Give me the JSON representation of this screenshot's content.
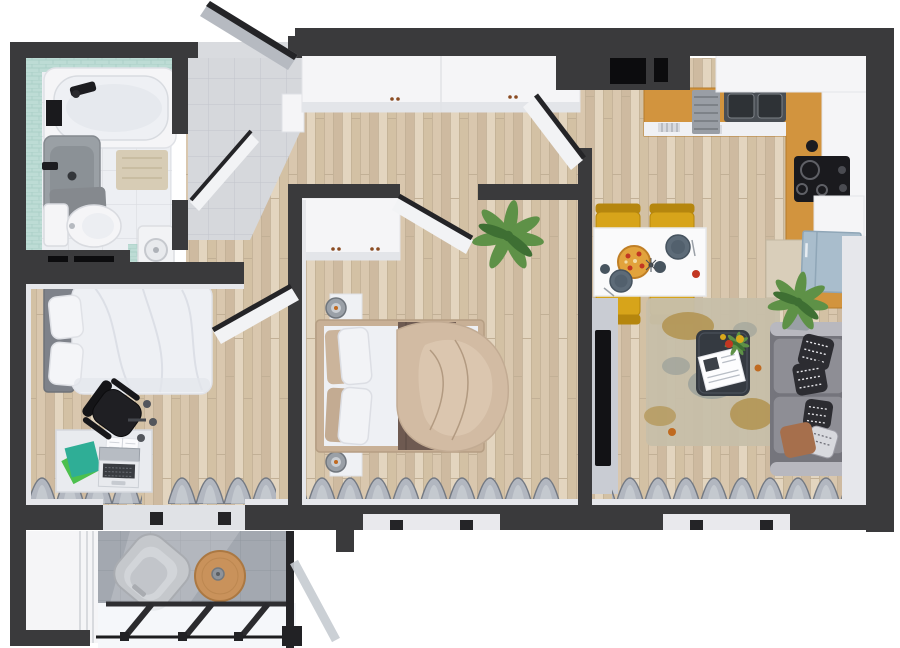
{
  "scene": {
    "type": "3d-floor-plan-top-view",
    "rooms": [
      {
        "name": "bathroom",
        "items": [
          "bathtub",
          "vanity-sink",
          "toilet",
          "washing-machine",
          "bath-mat",
          "toilet-mat"
        ]
      },
      {
        "name": "entry-hall",
        "items": [
          "front-door",
          "entry-tiles",
          "shoe-cabinet"
        ]
      },
      {
        "name": "hallway",
        "items": [
          "wardrobe"
        ]
      },
      {
        "name": "bedroom-1",
        "items": [
          "single-bed",
          "pillows",
          "desk",
          "laptop",
          "notebooks",
          "office-chair",
          "curtains",
          "window"
        ]
      },
      {
        "name": "bedroom-2",
        "items": [
          "double-bed",
          "duvet",
          "blanket",
          "wardrobe",
          "nightstand-top",
          "nightstand-bottom",
          "table-lamps",
          "plant",
          "curtains",
          "window"
        ]
      },
      {
        "name": "kitchen-living",
        "items": [
          "l-shaped-counter",
          "double-sink",
          "dish-rack",
          "cooktop",
          "kettle",
          "fridge",
          "tall-cabinet",
          "dining-table",
          "pizza",
          "plates",
          "dining-chairs",
          "tv",
          "rug",
          "coffee-table",
          "magazine",
          "flowers",
          "sofa",
          "pillows",
          "plants",
          "curtains",
          "window"
        ]
      },
      {
        "name": "balcony",
        "items": [
          "privacy-partition",
          "lounge-chair",
          "round-table",
          "glass-railing",
          "railing-struts"
        ]
      }
    ]
  },
  "colors": {
    "wall": "#3a3a3c",
    "wall2": "#242427",
    "niche": "#0c0c0e",
    "white": "#f5f5f7",
    "soft": "#e6e7eb",
    "wood": "#d9c7ae",
    "wood_a": "#cebaa0",
    "wood_b": "#e3d5bf",
    "wood_c": "#d3c1a4",
    "wood_line": "#c2b096",
    "tile": "#d6d8dc",
    "tile_line": "#c2c5cb",
    "bath": "#edeff3",
    "bath_line": "#dadce1",
    "mint": "#bddcd5",
    "mint_line": "#a6cdc4",
    "balc": "#a3a8b0",
    "balc_line": "#91979f",
    "counter": "#d2943e",
    "counter_dark": "#b57c2c",
    "sink": "#4a4f55",
    "sink2": "#2e3236",
    "steel": "#9aa0a7",
    "steel_dark": "#70767d",
    "yellow": "#d7a41a",
    "yellow2": "#b5860e",
    "plate": "#5d6b78",
    "pizza": "#e2a33c",
    "red": "#c23722",
    "sofa": "#8e8e95",
    "sofa2": "#75757c",
    "sofa3": "#a6a6ad",
    "cap": "#b8b8bf",
    "pil": "#2c2c31",
    "pil2": "#d8d9de",
    "brown": "#a66f4c",
    "ctab": "#353a41",
    "rug": "#c7bea9",
    "rug_tan": "#b29350",
    "rug_gray": "#9aa09a",
    "tv": "#121215",
    "panel": "#c9ccd3",
    "fridge": "#a9bdcc",
    "fridge2": "#8fa6b7",
    "tancab": "#d9ceba",
    "duvet": "#d2bba3",
    "duvet2": "#e1cfba",
    "duvet_line": "#b29a81",
    "blanket": "#6e5a51",
    "bedw": "#eef0f4",
    "tan": "#c8b096",
    "head": "#7e828a",
    "curt": "#b2b7c0",
    "curt2": "#737983",
    "curt3": "#d3d6db",
    "plant": "#5e9147",
    "plant2": "#3e6f33",
    "desk": "#e9ebef",
    "laptop_scr": "#b7bcc3",
    "key": "#393c41",
    "teal": "#2fae96",
    "green": "#4cc04e",
    "chairb": "#1f1f23",
    "door": "#d9dbdf",
    "doorg": "#b6bac1",
    "cork": "#c9925b",
    "cork2": "#ab7842",
    "lounge": "#c5c8cc",
    "lounge2": "#a9acb1",
    "glass": "#f3f6f9",
    "sill": "#e9e9ed",
    "mat": "#d7ccb5",
    "gmat": "#85898e",
    "wm": "#f2f3f5",
    "orange": "#c06a20"
  }
}
